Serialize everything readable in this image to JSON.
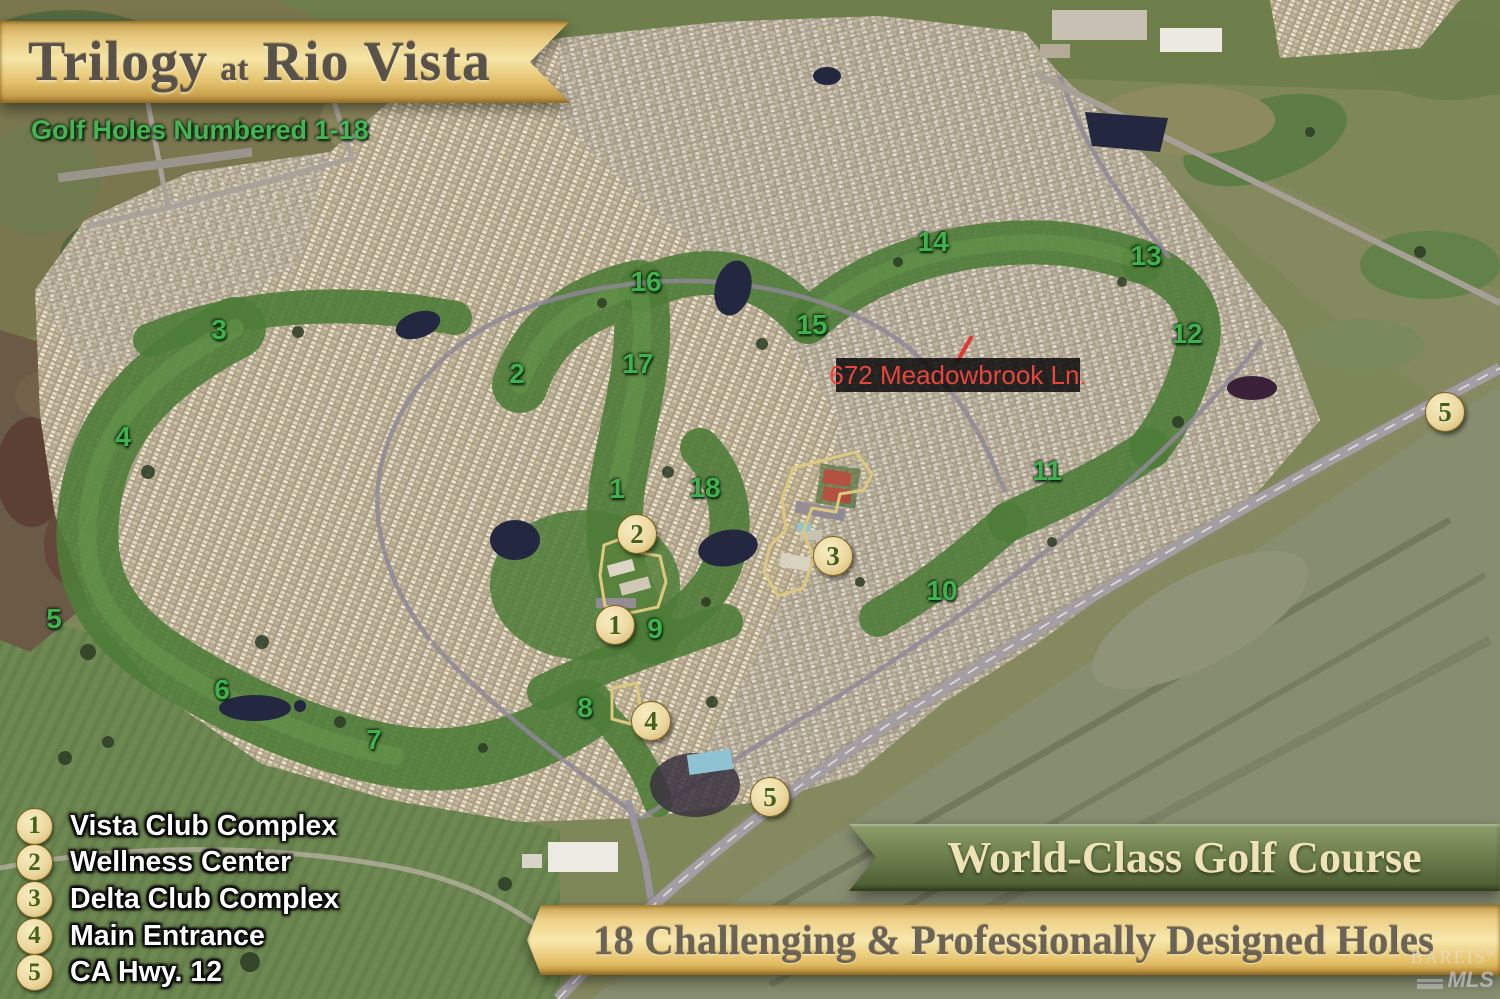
{
  "header": {
    "title": {
      "main": "Trilogy",
      "connector": "at",
      "place": "Rio Vista"
    },
    "subtitle": "Golf Holes Numbered 1-18"
  },
  "map": {
    "address_label": "672 Meadowbrook Ln.",
    "holes": [
      "1",
      "2",
      "3",
      "4",
      "5",
      "6",
      "7",
      "8",
      "9",
      "10",
      "11",
      "12",
      "13",
      "14",
      "15",
      "16",
      "17",
      "18"
    ],
    "markers": [
      "1",
      "2",
      "3",
      "4",
      "5",
      "5"
    ]
  },
  "legend": {
    "items": [
      {
        "num": "1",
        "label": "Vista Club Complex"
      },
      {
        "num": "2",
        "label": "Wellness Center"
      },
      {
        "num": "3",
        "label": "Delta Club Complex"
      },
      {
        "num": "4",
        "label": "Main Entrance"
      },
      {
        "num": "5",
        "label": "CA Hwy. 12"
      }
    ]
  },
  "banners": {
    "golf_course": "World-Class Golf Course",
    "holes_banner": "18 Challenging & Professionally Designed Holes"
  },
  "watermark": {
    "brand": "BAREIS",
    "reg": "®",
    "mls": "MLS"
  },
  "colors": {
    "ribbon_gold": "#f6e5a6",
    "ribbon_green": "#728450",
    "hole_number_green": "#3fb14d",
    "marker_fill": "#ecd9a0",
    "marker_text": "#44601a",
    "address_red": "#e64540",
    "golf_green": "#4e7c38",
    "housing_tan": "#b3a78c"
  }
}
